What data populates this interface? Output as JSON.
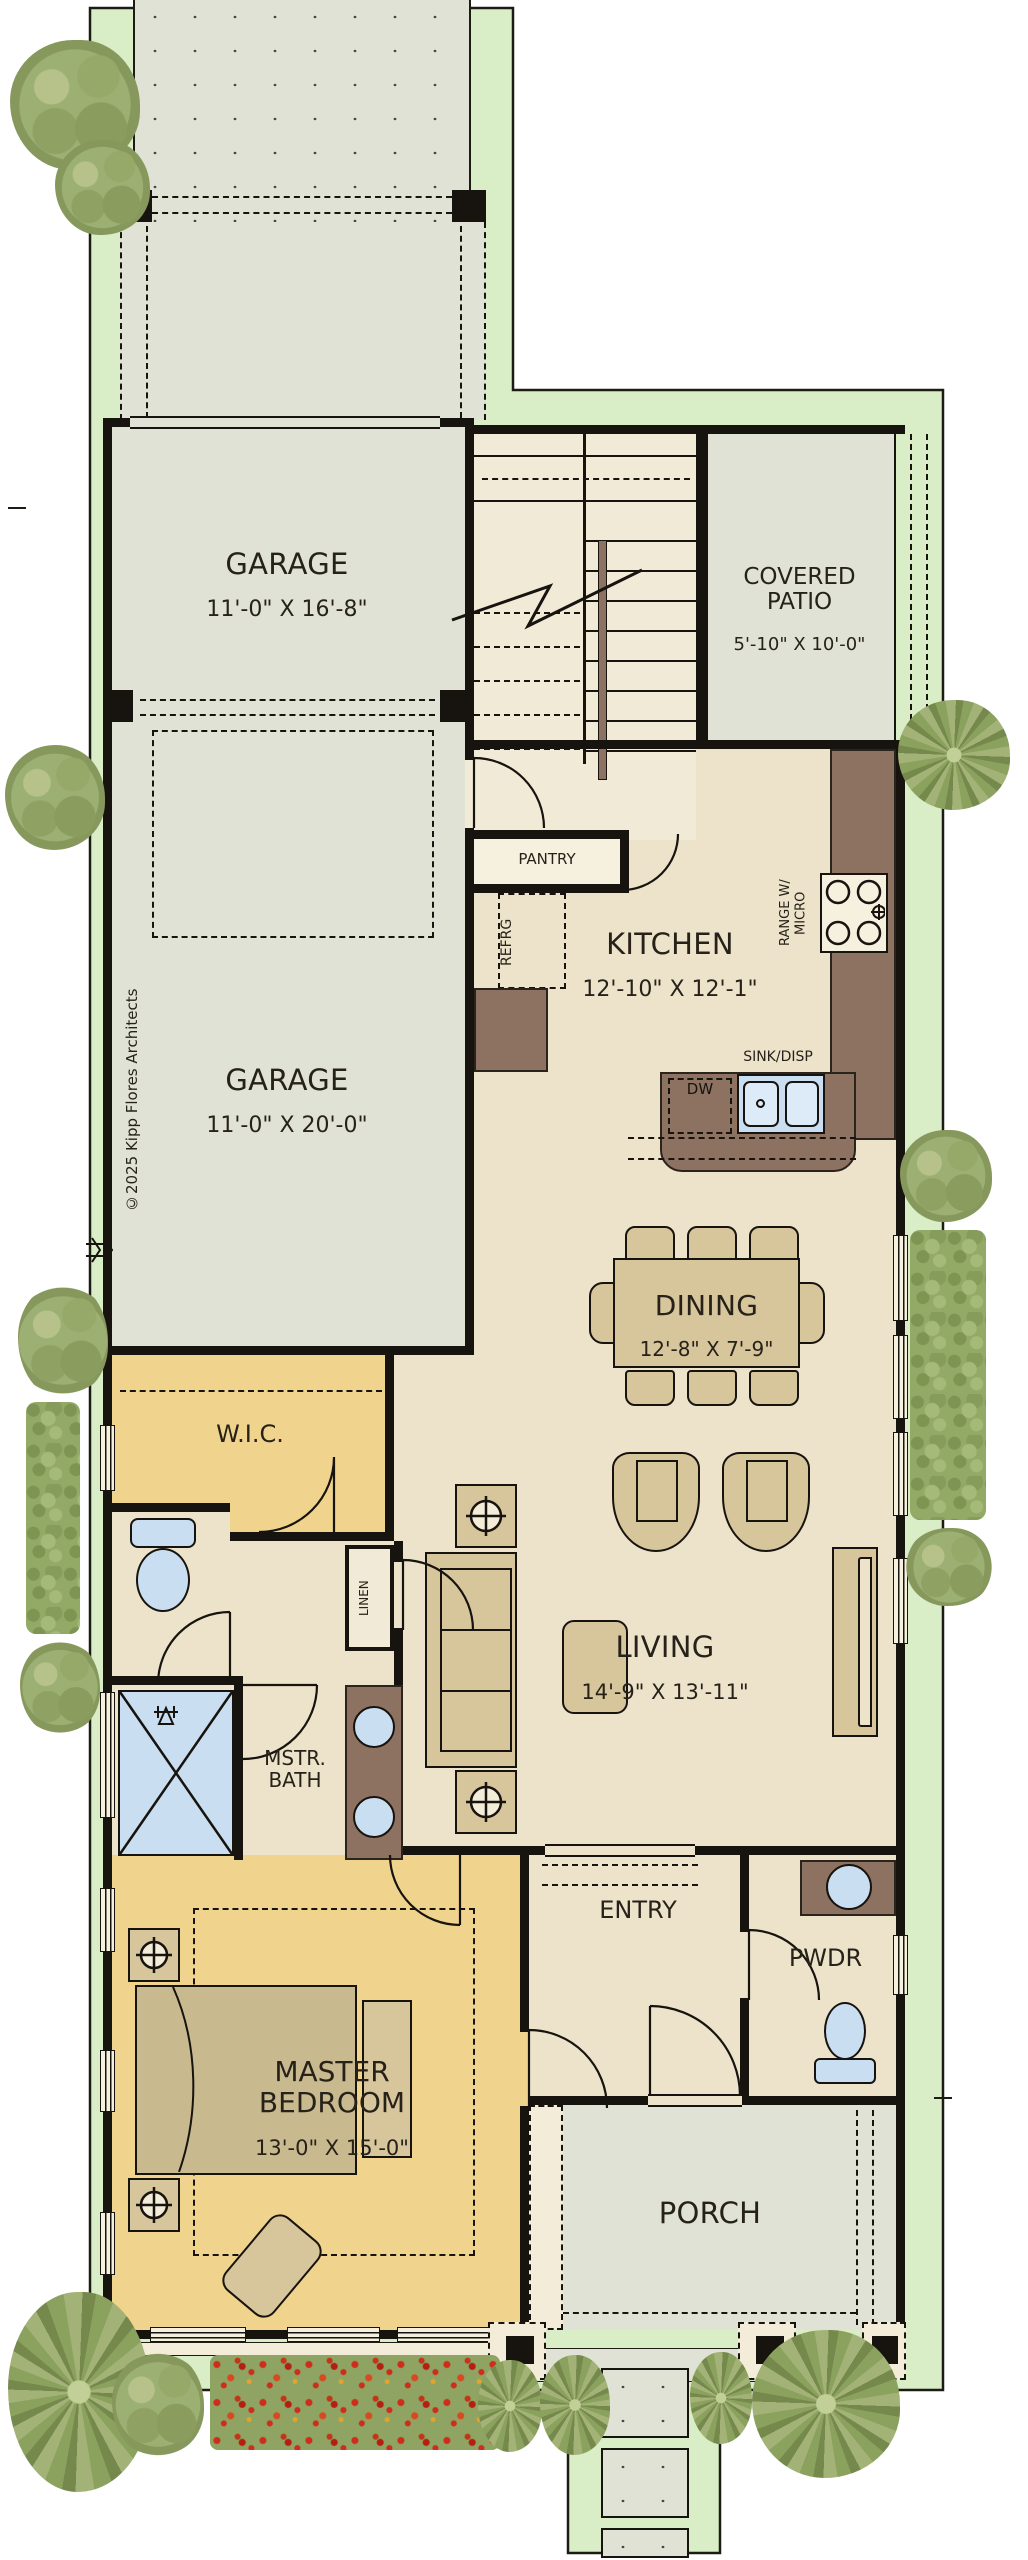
{
  "plan": {
    "copyright": "©2025 Kipp Flores Architects",
    "rooms": {
      "garage_front": {
        "name": "GARAGE",
        "dims": "11'-0\" X 16'-8\""
      },
      "garage_back": {
        "name": "GARAGE",
        "dims": "11'-0\" X 20'-0\""
      },
      "covered_patio": {
        "name": "COVERED PATIO",
        "dims": "5'-10\" X 10'-0\""
      },
      "kitchen": {
        "name": "KITCHEN",
        "dims": "12'-10\" X 12'-1\""
      },
      "dining": {
        "name": "DINING",
        "dims": "12'-8\" X 7'-9\""
      },
      "living": {
        "name": "LIVING",
        "dims": "14'-9\" X 13'-11\""
      },
      "master_bedroom": {
        "name": "MASTER BEDROOM",
        "dims": "13'-0\" X 15'-0\""
      },
      "wic": {
        "name": "W.I.C."
      },
      "mstr_bath": {
        "name": "MSTR. BATH"
      },
      "linen": {
        "name": "LINEN"
      },
      "pantry": {
        "name": "PANTRY"
      },
      "entry": {
        "name": "ENTRY"
      },
      "pwdr": {
        "name": "PWDR"
      },
      "porch": {
        "name": "PORCH"
      }
    },
    "fixtures": {
      "refrigerator": "REFRG",
      "range": "RANGE W/ MICRO",
      "sink": "SINK/DISP",
      "dishwasher": "DW"
    },
    "colors": {
      "lot_green": "#d9edc6",
      "concrete_gray": "#dfe2d4",
      "interior_cream": "#ece3ca",
      "bedroom_yellow": "#f0d48d",
      "cabinet_brown": "#8d7261",
      "fixture_blue": "#cadef2",
      "furniture_tan": "#d7c59b",
      "wall_black": "#17130e"
    }
  }
}
